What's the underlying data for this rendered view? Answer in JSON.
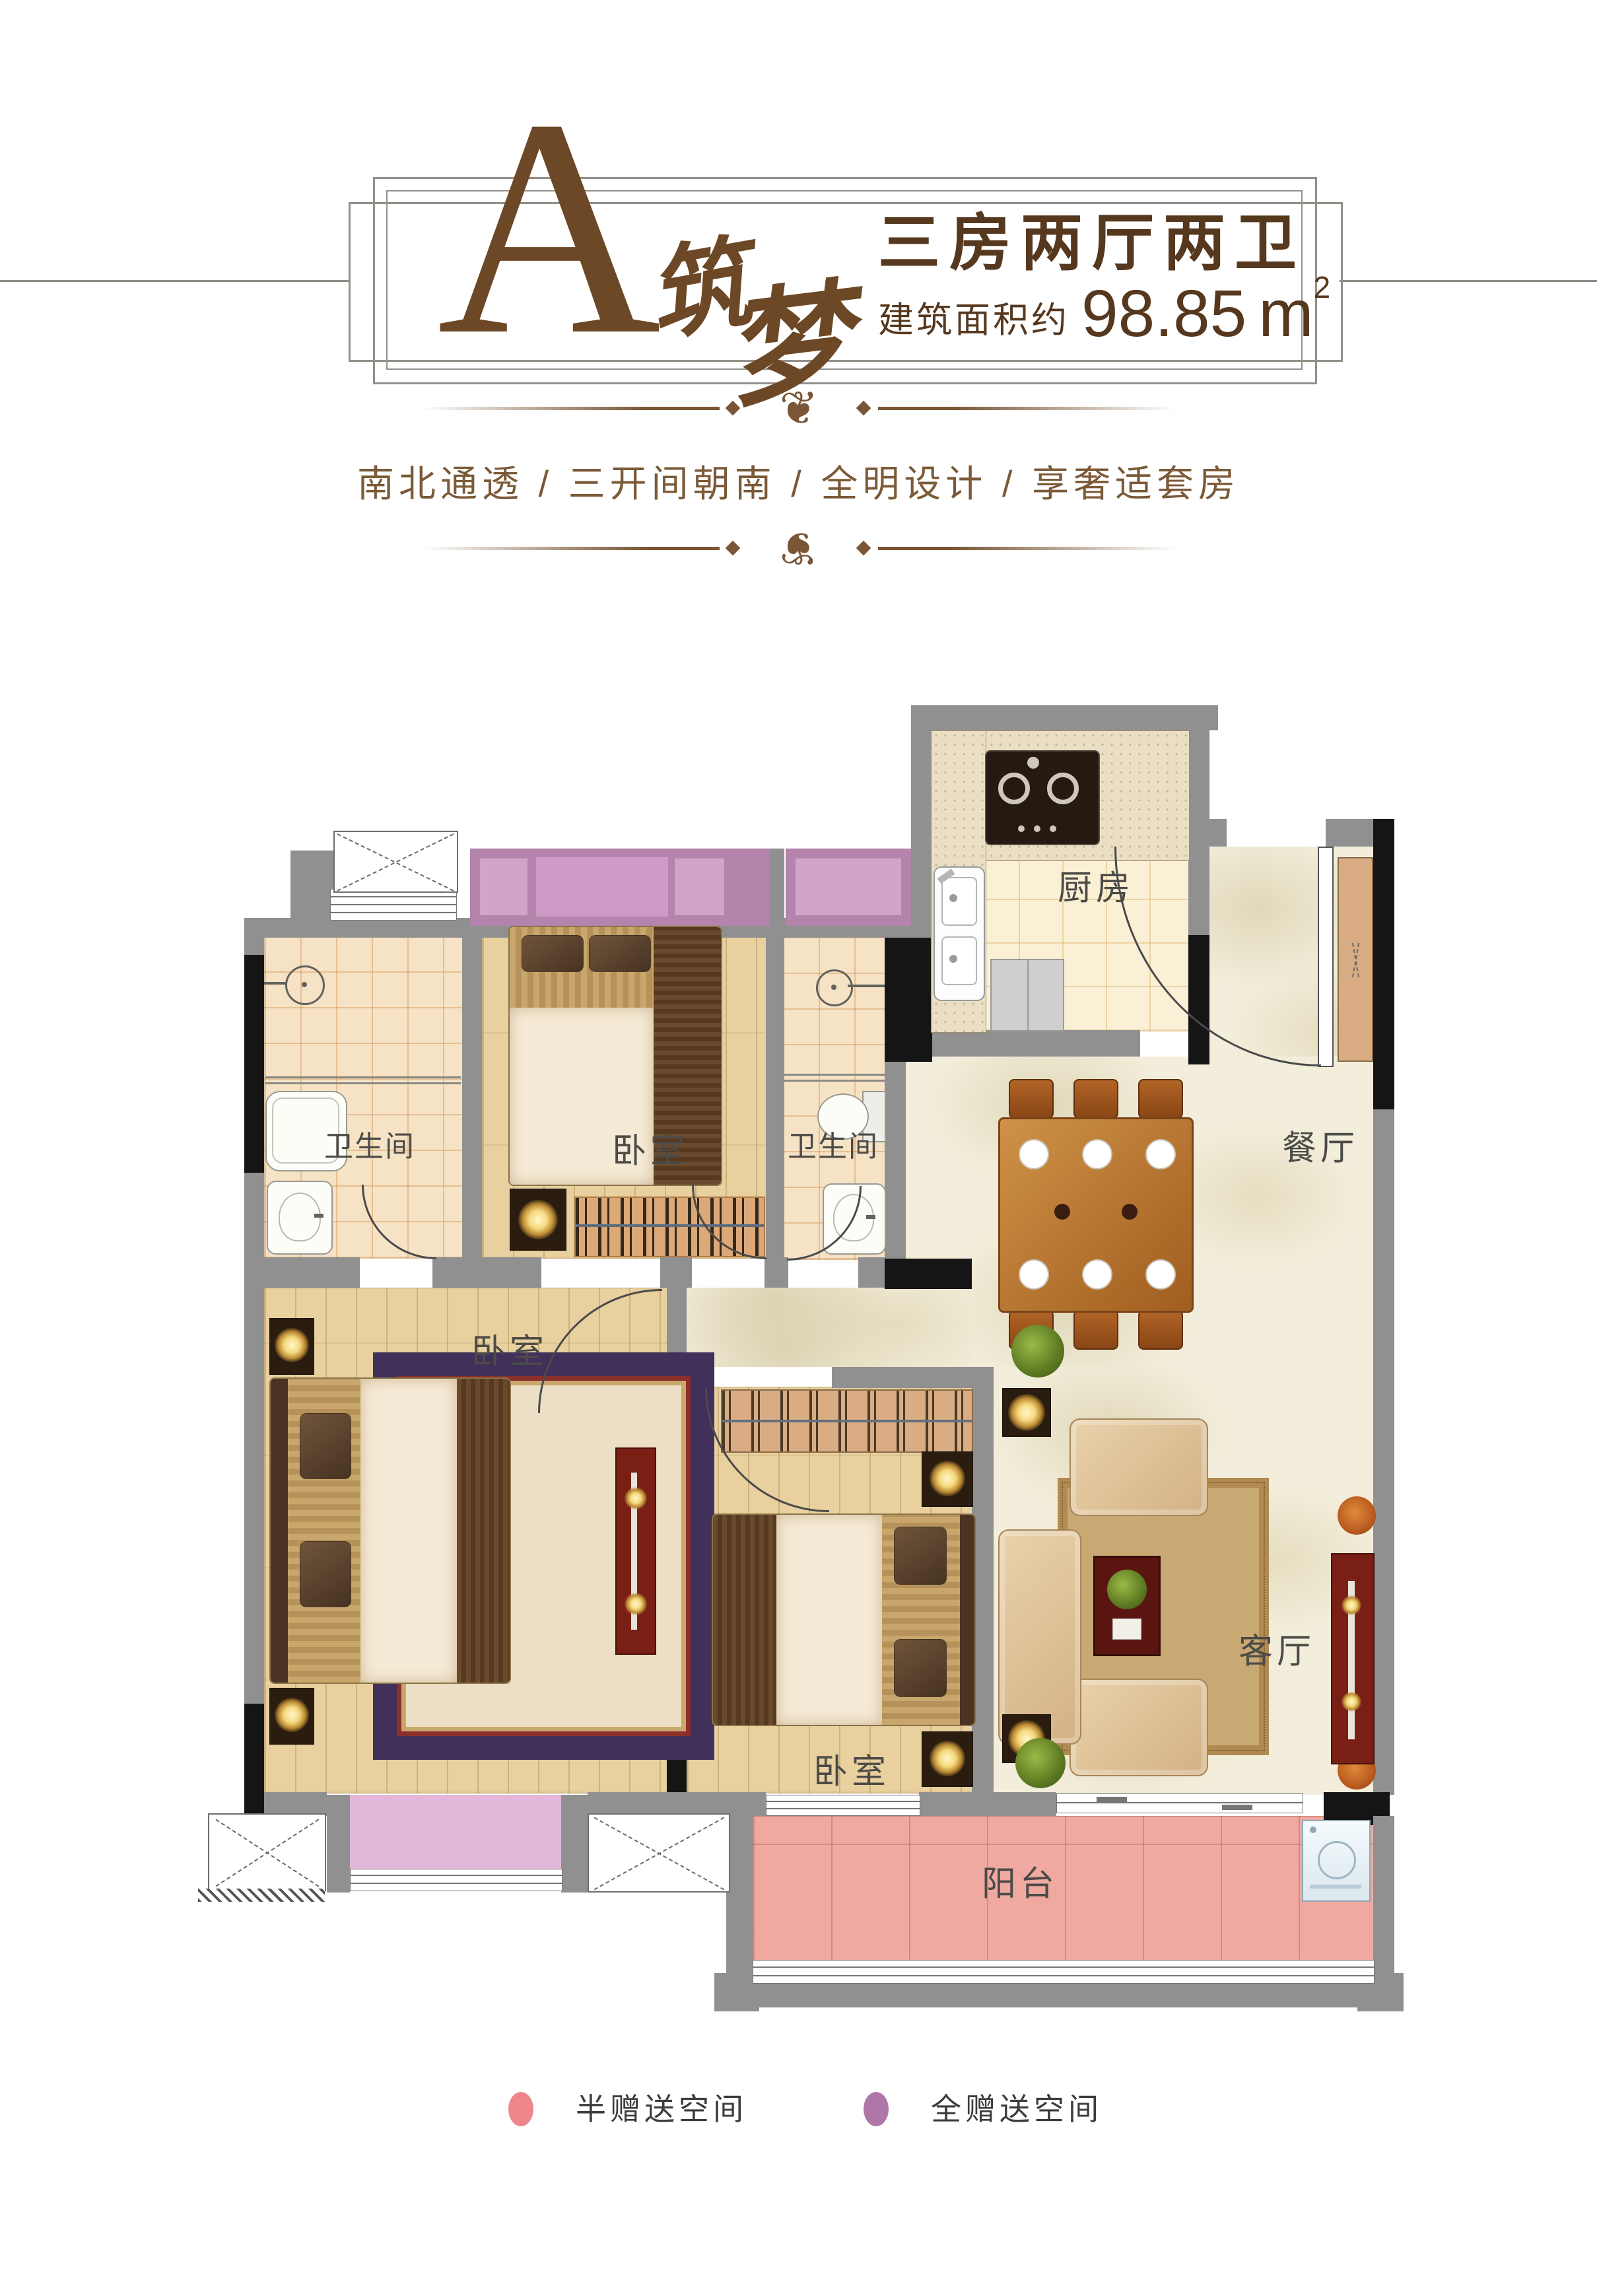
{
  "header": {
    "block_letter": "A",
    "block_name_char1": "筑",
    "block_name_char2": "梦",
    "layout_title": "三房两厅两卫",
    "area_prefix": "建筑面积约",
    "area_value": "98.85",
    "area_unit": "m",
    "area_sup": "2"
  },
  "tagline": {
    "text": "南北通透 / 三开间朝南 / 全明设计 / 享奢适套房"
  },
  "ornament": {
    "glyph": "❦"
  },
  "floorplan": {
    "rooms": {
      "kitchen": "厨房",
      "bath_top": "卫生间",
      "bath_mid": "卫生间",
      "bedroom_top": "卧室",
      "bedroom_master": "卧室",
      "bedroom_middle": "卧室",
      "dining": "餐厅",
      "living": "客厅",
      "balcony": "阳台"
    }
  },
  "legend": {
    "items": [
      {
        "label": "半赠送空间",
        "color": "#ee868c"
      },
      {
        "label": "全赠送空间",
        "color": "#af77a7"
      }
    ]
  },
  "colors": {
    "accent_brown": "#6d4826",
    "wall_gray": "#909090",
    "wall_black": "#151515",
    "bay_purple": "#b484ad",
    "bay_lavender": "#e2b7da",
    "balcony_pink": "#f0a9a1"
  }
}
